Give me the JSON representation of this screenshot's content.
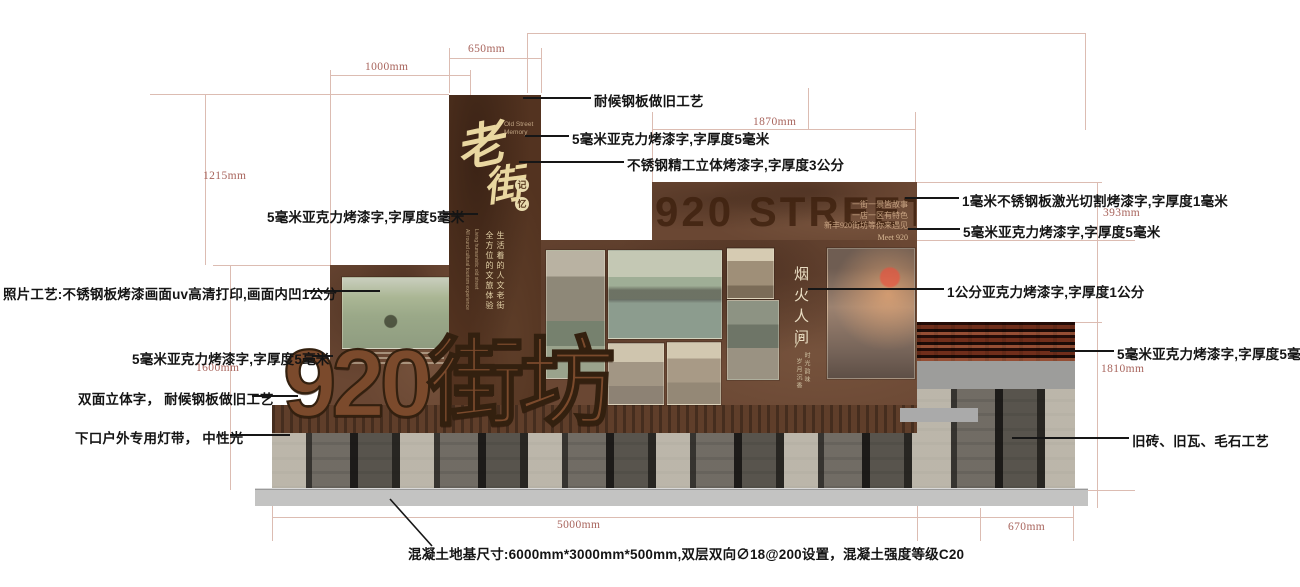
{
  "sign": {
    "main_char_1": "老",
    "main_char_2": "街",
    "subtitle_en_1": "Old Street",
    "subtitle_en_2": "Memory",
    "badge_char_1": "记",
    "badge_char_2": "忆",
    "tagline_cn_1": "生活着的人文老街",
    "tagline_cn_2": "全方位的文旅体验",
    "tagline_en_1": "Living humanistic old street",
    "tagline_en_2": "All round cultural tourism experience"
  },
  "street_panel": {
    "ghost_title": "920 STREET",
    "slogan_1": "一街一景皆故事",
    "slogan_2": "一店一区有特色",
    "slogan_3": "新丰920街坊等你来遇见",
    "slogan_en": "Meet 920",
    "photo_block_title": "烟火人间",
    "photo_block_sub_1": "时光韵味",
    "photo_block_sub_2": "岁月沉香"
  },
  "big_letters": "920街坊",
  "annotations": [
    {
      "id": "weathered-steel-top",
      "text": "耐候钢板做旧工艺"
    },
    {
      "id": "acrylic-5mm-top",
      "text": "5毫米亚克力烤漆字,字厚度5毫米"
    },
    {
      "id": "stainless-3cm",
      "text": "不锈钢精工立体烤漆字,字厚度3公分"
    },
    {
      "id": "laser-cut-1mm",
      "text": "1毫米不锈钢板激光切割烤漆字,字厚度1毫米"
    },
    {
      "id": "acrylic-5mm-right-upper",
      "text": "5毫米亚克力烤漆字,字厚度5毫米"
    },
    {
      "id": "acrylic-1cm",
      "text": "1公分亚克力烤漆字,字厚度1公分"
    },
    {
      "id": "acrylic-5mm-right-lower",
      "text": "5毫米亚克力烤漆字,字厚度5毫米"
    },
    {
      "id": "old-brick-stone",
      "text": "旧砖、旧瓦、毛石工艺"
    },
    {
      "id": "acrylic-5mm-left-upper",
      "text": "5毫米亚克力烤漆字,字厚度5毫米"
    },
    {
      "id": "photo-uv-print",
      "text": "照片工艺:不锈钢板烤漆画面uv高清打印,画面内凹1公分"
    },
    {
      "id": "acrylic-5mm-left-mid",
      "text": "5毫米亚克力烤漆字,字厚度5毫米"
    },
    {
      "id": "double-sided-letters",
      "text": "双面立体字， 耐候钢板做旧工艺"
    },
    {
      "id": "light-strip",
      "text": "下口户外专用灯带， 中性光"
    }
  ],
  "foundation_note": "混凝土地基尺寸:6000mm*3000mm*500mm,双层双向∅18@200设置，混凝土强度等级C20",
  "dims": {
    "d650": "650mm",
    "d1000": "1000mm",
    "d1870": "1870mm",
    "d1215": "1215mm",
    "d1600": "1600mm",
    "d393": "393mm",
    "d1810": "1810mm",
    "d5000": "5000mm",
    "d670": "670mm"
  },
  "colors": {
    "panel_brown": "#6a4733",
    "sign_brown": "#533320",
    "rust_letters": "#7b4a2c",
    "dimension_line": "#dcbcb2",
    "dimension_text": "#a8645c",
    "annotation_text": "#141414",
    "stone_dark": "#2f2d2a",
    "slab_gray": "#c3c3c2"
  }
}
